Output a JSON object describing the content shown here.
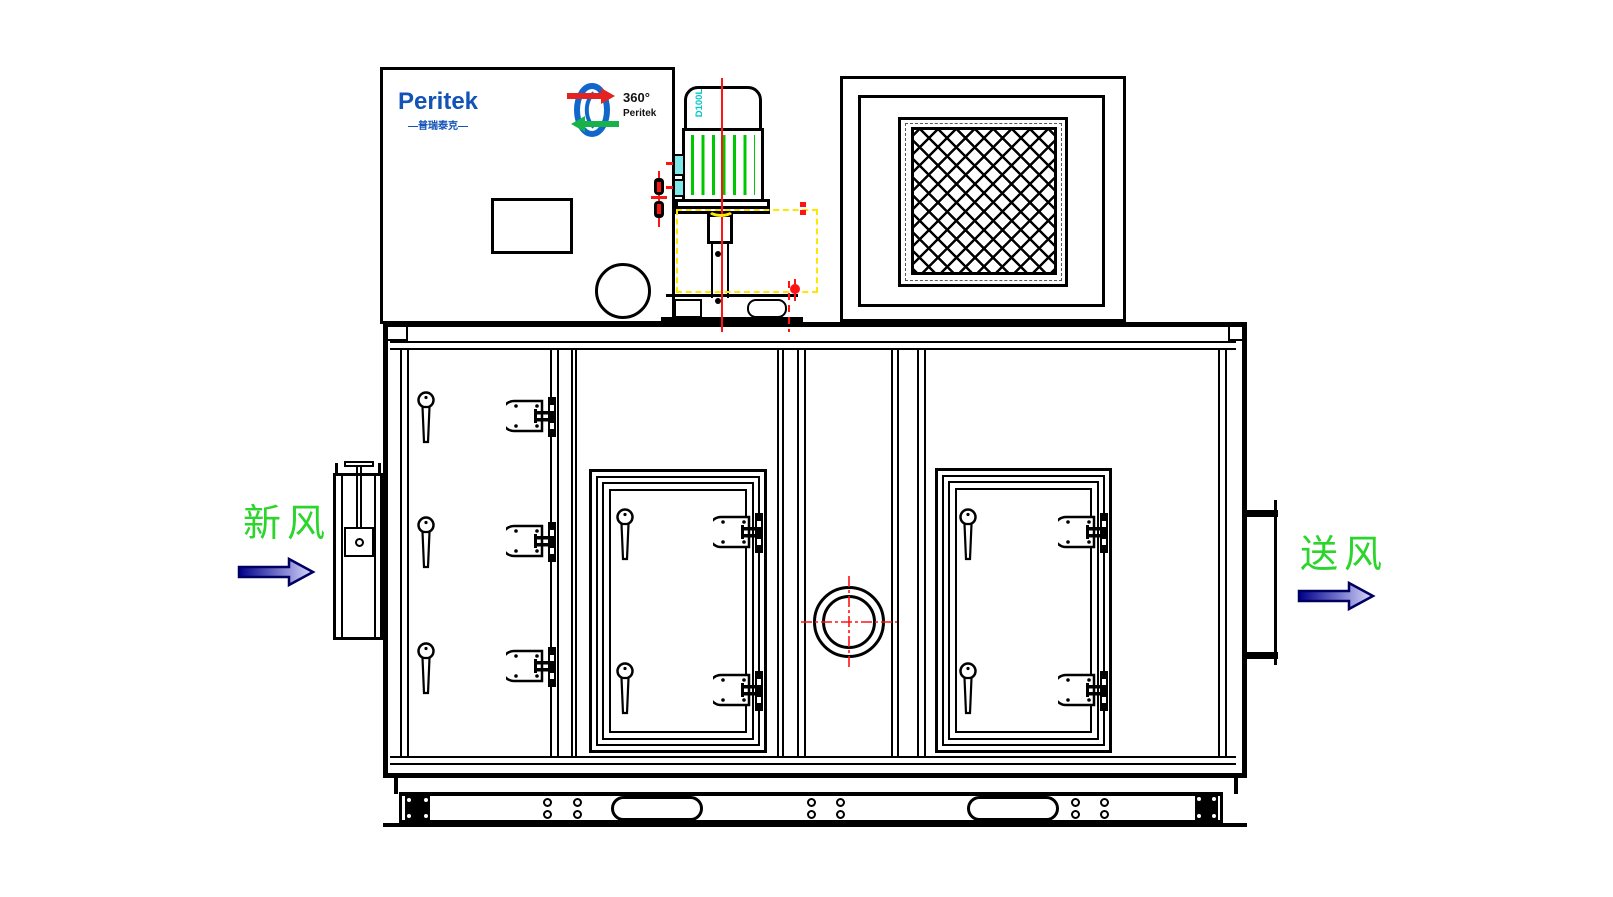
{
  "labels": {
    "brand_logo": "Peritek",
    "brand_logo_cn": "—普瑞泰克—",
    "rotor_logo_degrees": "360°",
    "rotor_logo_brand": "Peritek",
    "motor_frame": "D100L",
    "inlet": "新风",
    "outlet": "送风"
  },
  "colors": {
    "line_black": "#000000",
    "brand_blue": "#1253B5",
    "rotor_blue": "#1166CC",
    "rotor_red": "#E32222",
    "rotor_green": "#18B24B",
    "centerline_red": "#FF1414",
    "highlight_yellow": "#FFE800",
    "fin_green": "#00C800",
    "label_green": "#2BD52B",
    "motor_label_cyan": "#00C8C8",
    "arrow_dark": "#00008B",
    "arrow_light": "#D8D8FF"
  }
}
